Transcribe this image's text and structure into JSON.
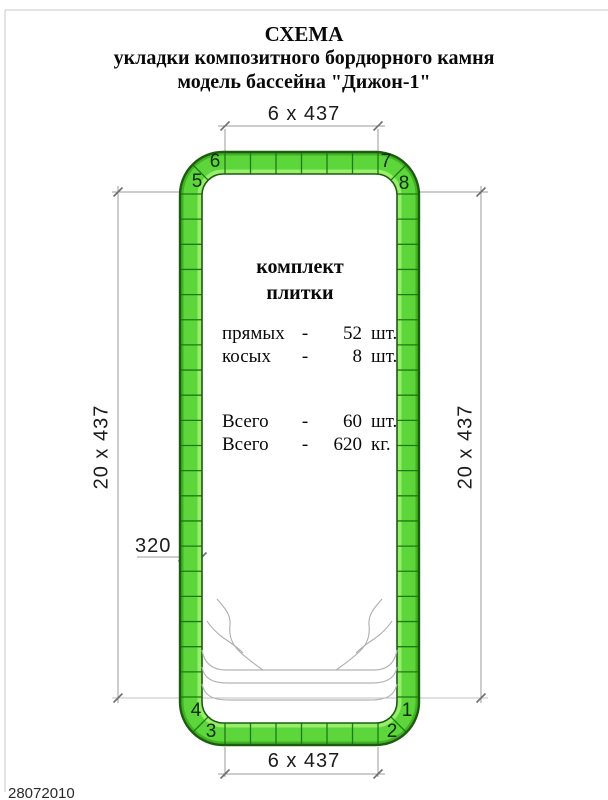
{
  "title": {
    "line1": "СХЕМА",
    "line2": "укладки композитного бордюрного камня",
    "line3": "модель бассейна  \"Дижон-1\""
  },
  "dimensions": {
    "top": "6 x 437",
    "bottom": "6 x 437",
    "left": "20 x 437",
    "right": "20 x 437",
    "tile_width": "320"
  },
  "kit": {
    "heading_line1": "комплект",
    "heading_line2": "плитки",
    "rows": [
      {
        "name": "прямых",
        "dash": "-",
        "value": "52",
        "unit": "шт."
      },
      {
        "name": "косых",
        "dash": "-",
        "value": "8",
        "unit": "шт."
      },
      {
        "name": "Всего",
        "dash": "-",
        "value": "60",
        "unit": "шт."
      },
      {
        "name": "Всего",
        "dash": "-",
        "value": "620",
        "unit": "кг."
      }
    ]
  },
  "corner_labels": [
    "1",
    "2",
    "3",
    "4",
    "5",
    "6",
    "7",
    "8"
  ],
  "footer": {
    "date": "28072010"
  },
  "colors": {
    "tile_green": "#5cd63a",
    "tile_green_light": "#97ee6a",
    "tile_green_dark": "#41b224",
    "outline_dark": "#1d5c10",
    "joint_green": "#1e7a14",
    "dim_gray": "#9b9b9b",
    "curve_gray": "#b5b5b5"
  }
}
